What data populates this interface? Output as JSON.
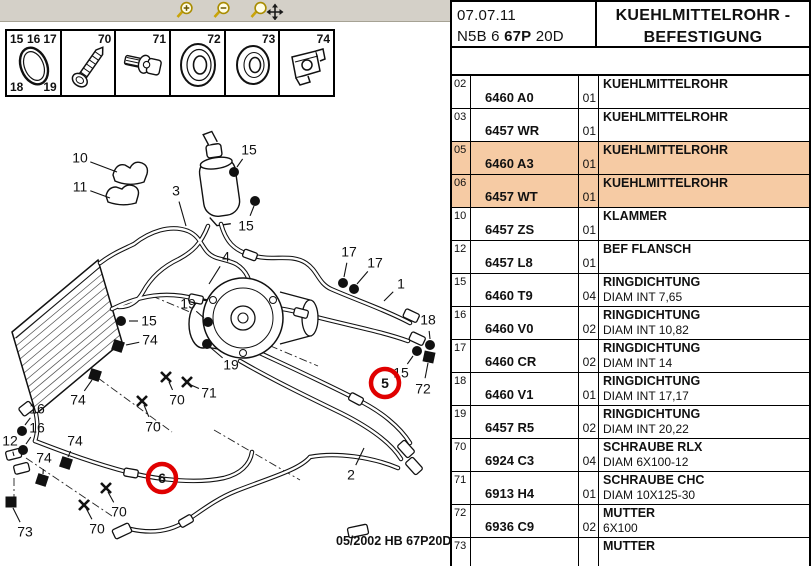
{
  "toolbar": {
    "icons": [
      {
        "name": "zoom-in"
      },
      {
        "name": "zoom-out"
      },
      {
        "name": "zoom-pan"
      }
    ]
  },
  "parts_strip": {
    "cells": [
      {
        "icon": "o-ring",
        "corner_labels": {
          "tl": "15",
          "tm": "16",
          "tr": "17",
          "bl": "18",
          "br": "19"
        }
      },
      {
        "icon": "screw",
        "label": "70"
      },
      {
        "icon": "bolt-washer",
        "label": "71"
      },
      {
        "icon": "grommet",
        "label": "72"
      },
      {
        "icon": "ring",
        "label": "73"
      },
      {
        "icon": "clip-nut",
        "label": "74"
      }
    ]
  },
  "diagram": {
    "footer": "05/2002  HB 67P20D",
    "red": "#e00000",
    "callouts": [
      {
        "t": "10",
        "x": 80,
        "y": 158,
        "lx": 117,
        "ly": 172
      },
      {
        "t": "11",
        "x": 80,
        "y": 187,
        "lx": 110,
        "ly": 198
      },
      {
        "t": "3",
        "x": 176,
        "y": 191,
        "lx": 186,
        "ly": 226
      },
      {
        "t": "15",
        "x": 249,
        "y": 150,
        "lx": 237,
        "ly": 167
      },
      {
        "t": "15",
        "x": 246,
        "y": 226,
        "lx": 254,
        "ly": 206
      },
      {
        "t": "4",
        "x": 226,
        "y": 257,
        "lx": 209,
        "ly": 284
      },
      {
        "t": "19",
        "x": 188,
        "y": 304,
        "lx": 204,
        "ly": 318
      },
      {
        "t": "19",
        "x": 231,
        "y": 365,
        "lx": 211,
        "ly": 348
      },
      {
        "t": "15",
        "x": 149,
        "y": 321,
        "lx": 129,
        "ly": 321
      },
      {
        "t": "74",
        "x": 150,
        "y": 340,
        "lx": 126,
        "ly": 345
      },
      {
        "t": "17",
        "x": 349,
        "y": 252,
        "lx": 344,
        "ly": 277
      },
      {
        "t": "17",
        "x": 375,
        "y": 263,
        "lx": 357,
        "ly": 284
      },
      {
        "t": "1",
        "x": 401,
        "y": 284,
        "lx": 384,
        "ly": 301
      },
      {
        "t": "18",
        "x": 428,
        "y": 320,
        "lx": 430,
        "ly": 339
      },
      {
        "t": "15",
        "x": 401,
        "y": 373,
        "lx": 413,
        "ly": 356
      },
      {
        "t": "72",
        "x": 423,
        "y": 389,
        "lx": 428,
        "ly": 363
      },
      {
        "t": "16",
        "x": 37,
        "y": 409,
        "lx": 25,
        "ly": 425
      },
      {
        "t": "16",
        "x": 37,
        "y": 428,
        "lx": 26,
        "ly": 444
      },
      {
        "t": "12",
        "x": 10,
        "y": 441,
        "lx": 14,
        "ly": 456
      },
      {
        "t": "74",
        "x": 78,
        "y": 400,
        "lx": 92,
        "ly": 380
      },
      {
        "t": "74",
        "x": 75,
        "y": 441,
        "lx": 68,
        "ly": 457
      },
      {
        "t": "74",
        "x": 44,
        "y": 458,
        "lx": 43,
        "ly": 474
      },
      {
        "t": "70",
        "x": 177,
        "y": 400,
        "lx": 169,
        "ly": 382
      },
      {
        "t": "71",
        "x": 209,
        "y": 393,
        "lx": 191,
        "ly": 385
      },
      {
        "t": "70",
        "x": 153,
        "y": 427,
        "lx": 144,
        "ly": 405
      },
      {
        "t": "70",
        "x": 119,
        "y": 512,
        "lx": 108,
        "ly": 492
      },
      {
        "t": "70",
        "x": 97,
        "y": 529,
        "lx": 86,
        "ly": 508
      },
      {
        "t": "73",
        "x": 25,
        "y": 532,
        "lx": 13,
        "ly": 508
      },
      {
        "t": "2",
        "x": 351,
        "y": 475,
        "lx": 364,
        "ly": 448
      }
    ],
    "markers": [
      {
        "type": "dot",
        "x": 234,
        "y": 172
      },
      {
        "type": "dot",
        "x": 255,
        "y": 201
      },
      {
        "type": "dot",
        "x": 121,
        "y": 321
      },
      {
        "type": "dot",
        "x": 208,
        "y": 322
      },
      {
        "type": "dot",
        "x": 207,
        "y": 344
      },
      {
        "type": "dot",
        "x": 343,
        "y": 283
      },
      {
        "type": "dot",
        "x": 354,
        "y": 289
      },
      {
        "type": "dot",
        "x": 430,
        "y": 345
      },
      {
        "type": "dot",
        "x": 417,
        "y": 351
      },
      {
        "type": "dot",
        "x": 22,
        "y": 431
      },
      {
        "type": "dot",
        "x": 23,
        "y": 450
      },
      {
        "type": "square",
        "x": 118,
        "y": 346,
        "rot": 18
      },
      {
        "type": "square",
        "x": 95,
        "y": 375,
        "rot": 18
      },
      {
        "type": "square",
        "x": 66,
        "y": 463,
        "rot": 18
      },
      {
        "type": "square",
        "x": 42,
        "y": 480,
        "rot": 18
      },
      {
        "type": "square",
        "x": 429,
        "y": 357,
        "rot": 12
      },
      {
        "type": "square",
        "x": 11,
        "y": 502,
        "rot": 0
      },
      {
        "type": "cross",
        "x": 166,
        "y": 377
      },
      {
        "type": "cross",
        "x": 187,
        "y": 382
      },
      {
        "type": "cross",
        "x": 142,
        "y": 401
      },
      {
        "type": "cross",
        "x": 106,
        "y": 488
      },
      {
        "type": "cross",
        "x": 84,
        "y": 505
      }
    ],
    "highlight_circles": [
      {
        "text": "5",
        "x": 385,
        "y": 383
      },
      {
        "text": "6",
        "x": 162,
        "y": 478
      }
    ]
  },
  "table": {
    "date": "07.07.11",
    "code_prefix": "N5B 6 ",
    "code_bold": "67P",
    "code_suffix": " 20D",
    "title_line1": "KUEHLMITTELROHR -",
    "title_line2": "BEFESTIGUNG",
    "highlight_color": "#f6cba4",
    "rows": [
      {
        "ref": "02",
        "part": "6460 A0",
        "qty": "01",
        "desc": "KUEHLMITTELROHR",
        "note": "",
        "hl": false
      },
      {
        "ref": "03",
        "part": "6457 WR",
        "qty": "01",
        "desc": "KUEHLMITTELROHR",
        "note": "",
        "hl": false
      },
      {
        "ref": "05",
        "part": "6460 A3",
        "qty": "01",
        "desc": "KUEHLMITTELROHR",
        "note": "",
        "hl": true
      },
      {
        "ref": "06",
        "part": "6457 WT",
        "qty": "01",
        "desc": "KUEHLMITTELROHR",
        "note": "",
        "hl": true
      },
      {
        "ref": "10",
        "part": "6457 ZS",
        "qty": "01",
        "desc": "KLAMMER",
        "note": "",
        "hl": false
      },
      {
        "ref": "12",
        "part": "6457 L8",
        "qty": "01",
        "desc": "BEF FLANSCH",
        "note": "",
        "hl": false
      },
      {
        "ref": "15",
        "part": "6460 T9",
        "qty": "04",
        "desc": "RINGDICHTUNG",
        "note": "DIAM INT 7,65",
        "hl": false
      },
      {
        "ref": "16",
        "part": "6460 V0",
        "qty": "02",
        "desc": "RINGDICHTUNG",
        "note": "DIAM INT 10,82",
        "hl": false
      },
      {
        "ref": "17",
        "part": "6460 CR",
        "qty": "02",
        "desc": "RINGDICHTUNG",
        "note": "DIAM INT 14",
        "hl": false
      },
      {
        "ref": "18",
        "part": "6460 V1",
        "qty": "01",
        "desc": "RINGDICHTUNG",
        "note": "DIAM INT 17,17",
        "hl": false
      },
      {
        "ref": "19",
        "part": "6457 R5",
        "qty": "02",
        "desc": "RINGDICHTUNG",
        "note": "DIAM INT 20,22",
        "hl": false
      },
      {
        "ref": "70",
        "part": "6924 C3",
        "qty": "04",
        "desc": "SCHRAUBE RLX",
        "note": "DIAM 6X100-12",
        "hl": false
      },
      {
        "ref": "71",
        "part": "6913 H4",
        "qty": "01",
        "desc": "SCHRAUBE CHC",
        "note": "DIAM 10X125-30",
        "hl": false
      },
      {
        "ref": "72",
        "part": "6936 C9",
        "qty": "02",
        "desc": "MUTTER",
        "note": "6X100",
        "hl": false
      },
      {
        "ref": "73",
        "part": "",
        "qty": "",
        "desc": "MUTTER",
        "note": "",
        "hl": false
      }
    ]
  }
}
